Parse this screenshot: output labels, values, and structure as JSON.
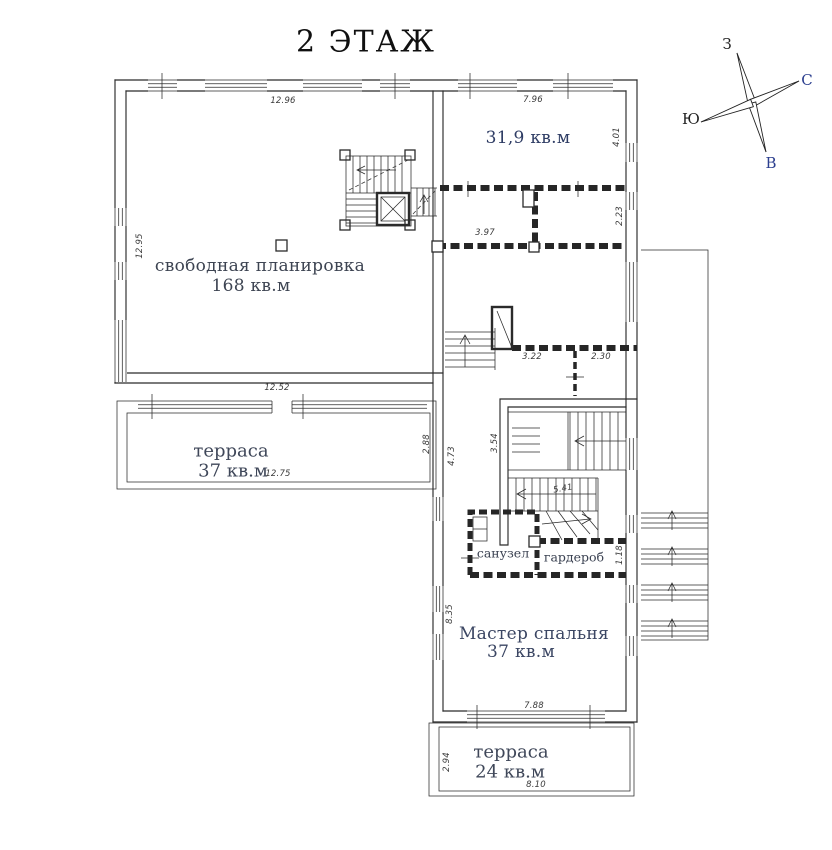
{
  "title": "2 ЭТАЖ",
  "compass": {
    "west": "З",
    "north": "С",
    "south": "Ю",
    "east": "В"
  },
  "rooms": {
    "room319": {
      "area": "31,9 кв.м"
    },
    "free": {
      "name": "свободная планировка",
      "area": "168 кв.м"
    },
    "terrace_left": {
      "name": "терраса",
      "area": "37 кв.м"
    },
    "bathroom": {
      "name": "санузел"
    },
    "wardrobe": {
      "name": "гардероб"
    },
    "master": {
      "name": "Мастер спальня",
      "area": "37 кв.м"
    },
    "terrace_bottom": {
      "name": "терраса",
      "area": "24 кв.м"
    }
  },
  "dimensions": {
    "top_main": "12.96",
    "top_room319": "7.96",
    "right_room319": "4.01",
    "left_main": "12.95",
    "room_397": "3.97",
    "room_223": "2.23",
    "hall_322": "3.22",
    "hall_230": "2.30",
    "terrace_top": "12.52",
    "terrace_width": "12.75",
    "terrace_depth": "2.88",
    "corridor_473": "4.73",
    "stair_354": "3.54",
    "stair_run": "5.41",
    "wardrobe_118": "1.18",
    "master_left": "8.35",
    "master_bottom": "7.88",
    "terrace2_depth": "2.94",
    "terrace2_width": "8.10"
  },
  "colors": {
    "room_label": "#35406b",
    "dimension_text": "#3a3a3a",
    "line": "#2b2b2b",
    "compass_letter_blue": "#2c3f8f"
  }
}
